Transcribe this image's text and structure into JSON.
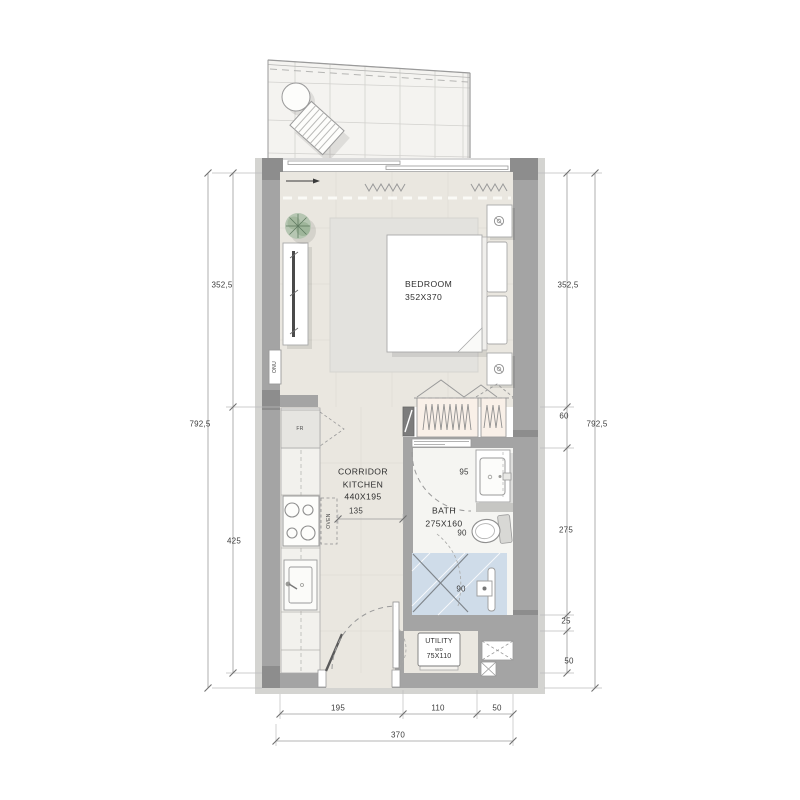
{
  "title": "Studio apartment floor plan",
  "colors": {
    "wall": "#a4a4a4",
    "wall-dark": "#8d8d8d",
    "wall-light": "#d4d4d1",
    "floor": "#eae7e0",
    "bath-floor": "#f5f5f2",
    "shower": "#cfdce9",
    "wardrobe": "#f9f0e8",
    "balcony": "#f4f3f0",
    "text": "#3c3c3c"
  },
  "rooms": {
    "bedroom": {
      "name": "BEDROOM",
      "size": "352X370"
    },
    "corridor_kitchen": {
      "line1": "CORRIDOR",
      "line2": "KITCHEN",
      "size": "440X195"
    },
    "bath": {
      "name": "BATH",
      "size": "275X160"
    },
    "utility": {
      "name": "UTILITY",
      "appliance": "WD",
      "size": "75X110"
    }
  },
  "labels": {
    "fridge": "FR",
    "oven": "OVEN",
    "onu": "ONU"
  },
  "dimensions": {
    "left": {
      "overall": "792,5",
      "bedroom": "352,5",
      "kitchen": "425"
    },
    "right": {
      "overall": "792,5",
      "bedroom": "352,5",
      "wardrobe": "60",
      "bath": "275",
      "ledge": "25",
      "shaft": "50"
    },
    "bottom": {
      "kitchen": "195",
      "utility": "110",
      "shaft": "50",
      "overall": "370"
    },
    "clearances": {
      "kitchen": "135",
      "bath_door": "95",
      "toilet": "90",
      "shower": "90"
    }
  }
}
